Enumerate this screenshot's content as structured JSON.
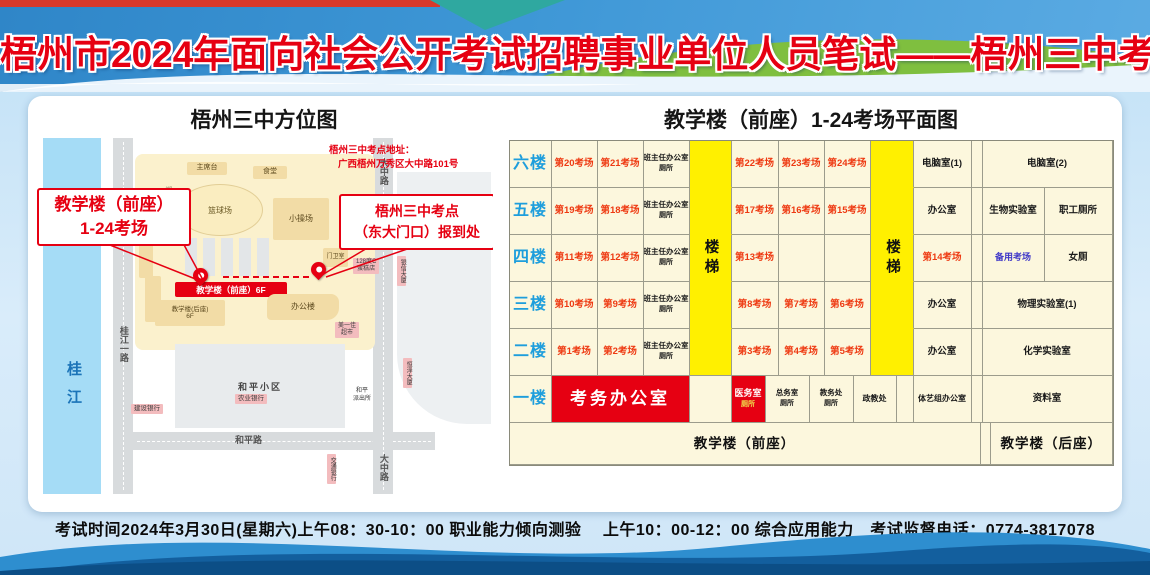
{
  "header": {
    "title": "梧州市2024年面向社会公开考试招聘事业单位人员笔试——梧州三中考点"
  },
  "map": {
    "title": "梧州三中方位图",
    "river": "桂江",
    "road_guijiang": "桂江一路",
    "road_heping": "和平路",
    "road_dazhong_top": "大中路",
    "road_dazhong_bottom": "大中路",
    "track": "塑胶跑道",
    "library": "图书综合楼",
    "stage": "主席台",
    "canteen": "食堂",
    "basketball": "篮球场",
    "playground": "小操场",
    "gatehouse": "门卫室",
    "office_building": "办公楼",
    "teaching_front_banner": "教学楼（前座）6F",
    "teaching_rear": "教学楼(后座)",
    "teaching_rear_floors": "6F",
    "community": "和平小区",
    "poi_ccb": "建设银行",
    "poi_abc": "农业银行",
    "poi_bocom": "交通银行",
    "poi_police_1": "和平",
    "poi_police_2": "派出所",
    "poi_market_1": "美一佳",
    "poi_market_2": "超市",
    "poi_cake_1": "128度C",
    "poi_cake_2": "蛋糕店",
    "poi_tower1": "银信大厦",
    "poi_tower2": "恒泽大厦",
    "callout1_line1": "教学楼（前座）",
    "callout1_line2": "1-24考场",
    "callout2_line1": "梧州三中考点",
    "callout2_line2": "（东大门口）报到处",
    "address_line1": "梧州三中考点地址：",
    "address_line2": "广西梧州万秀区大中路101号"
  },
  "plan": {
    "title": "教学楼（前座）1-24考场平面图",
    "floor_col_w": 42,
    "floors": [
      {
        "floor": "六楼",
        "cells": [
          {
            "t": "第20考场",
            "w": 46,
            "c": "c-exam"
          },
          {
            "t": "第21考场",
            "w": 46,
            "c": "c-exam"
          },
          {
            "t": "班主任办公室",
            "s": "厕所",
            "w": 46,
            "c": "c-small"
          },
          {
            "t": "",
            "w": 42,
            "c": "c-stair"
          },
          {
            "t": "第22考场",
            "w": 47,
            "c": "c-exam"
          },
          {
            "t": "第23考场",
            "w": 46,
            "c": "c-exam"
          },
          {
            "t": "第24考场",
            "w": 46,
            "c": "c-exam"
          },
          {
            "t": "",
            "w": 43,
            "c": "c-stair"
          },
          {
            "t": "电脑室(1)",
            "w": 58,
            "c": "c-room"
          },
          {
            "t": "",
            "w": 11,
            "c": "c-room"
          },
          {
            "t": "电脑室(2)",
            "w": 130,
            "c": "c-room"
          }
        ]
      },
      {
        "floor": "五楼",
        "cells": [
          {
            "t": "第19考场",
            "w": 46,
            "c": "c-exam"
          },
          {
            "t": "第18考场",
            "w": 46,
            "c": "c-exam"
          },
          {
            "t": "班主任办公室",
            "s": "厕所",
            "w": 46,
            "c": "c-small"
          },
          {
            "t": "",
            "w": 42,
            "c": "c-stair"
          },
          {
            "t": "第17考场",
            "w": 47,
            "c": "c-exam"
          },
          {
            "t": "第16考场",
            "w": 46,
            "c": "c-exam"
          },
          {
            "t": "第15考场",
            "w": 46,
            "c": "c-exam"
          },
          {
            "t": "",
            "w": 43,
            "c": "c-stair"
          },
          {
            "t": "办公室",
            "w": 58,
            "c": "c-room"
          },
          {
            "t": "",
            "w": 11,
            "c": "c-room"
          },
          {
            "t": "生物实验室",
            "w": 62,
            "c": "c-room"
          },
          {
            "t": "职工厕所",
            "w": 68,
            "c": "c-room"
          }
        ]
      },
      {
        "floor": "四楼",
        "cells": [
          {
            "t": "第11考场",
            "w": 46,
            "c": "c-exam"
          },
          {
            "t": "第12考场",
            "w": 46,
            "c": "c-exam"
          },
          {
            "t": "班主任办公室",
            "s": "厕所",
            "w": 46,
            "c": "c-small"
          },
          {
            "t": "楼梯",
            "w": 42,
            "c": "c-stair",
            "v": true
          },
          {
            "t": "第13考场",
            "w": 47,
            "c": "c-exam"
          },
          {
            "t": "",
            "w": 46,
            "c": "c-room"
          },
          {
            "t": "",
            "w": 46,
            "c": "c-room"
          },
          {
            "t": "楼梯",
            "w": 43,
            "c": "c-stair",
            "v": true
          },
          {
            "t": "第14考场",
            "w": 58,
            "c": "c-exam"
          },
          {
            "t": "",
            "w": 11,
            "c": "c-room"
          },
          {
            "t": "备用考场",
            "w": 62,
            "c": "c-backup"
          },
          {
            "t": "女厕",
            "w": 68,
            "c": "c-room"
          }
        ]
      },
      {
        "floor": "三楼",
        "cells": [
          {
            "t": "第10考场",
            "w": 46,
            "c": "c-exam"
          },
          {
            "t": "第9考场",
            "w": 46,
            "c": "c-exam"
          },
          {
            "t": "班主任办公室",
            "s": "厕所",
            "w": 46,
            "c": "c-small"
          },
          {
            "t": "",
            "w": 42,
            "c": "c-stair"
          },
          {
            "t": "第8考场",
            "w": 47,
            "c": "c-exam"
          },
          {
            "t": "第7考场",
            "w": 46,
            "c": "c-exam"
          },
          {
            "t": "第6考场",
            "w": 46,
            "c": "c-exam"
          },
          {
            "t": "",
            "w": 43,
            "c": "c-stair"
          },
          {
            "t": "办公室",
            "w": 58,
            "c": "c-room"
          },
          {
            "t": "",
            "w": 11,
            "c": "c-room"
          },
          {
            "t": "物理实验室(1)",
            "w": 130,
            "c": "c-room"
          }
        ]
      },
      {
        "floor": "二楼",
        "cells": [
          {
            "t": "第1考场",
            "w": 46,
            "c": "c-exam"
          },
          {
            "t": "第2考场",
            "w": 46,
            "c": "c-exam"
          },
          {
            "t": "班主任办公室",
            "s": "厕所",
            "w": 46,
            "c": "c-small"
          },
          {
            "t": "",
            "w": 42,
            "c": "c-stair end"
          },
          {
            "t": "第3考场",
            "w": 47,
            "c": "c-exam"
          },
          {
            "t": "第4考场",
            "w": 46,
            "c": "c-exam"
          },
          {
            "t": "第5考场",
            "w": 46,
            "c": "c-exam"
          },
          {
            "t": "",
            "w": 43,
            "c": "c-stair end"
          },
          {
            "t": "办公室",
            "w": 58,
            "c": "c-room"
          },
          {
            "t": "",
            "w": 11,
            "c": "c-room"
          },
          {
            "t": "化学实验室",
            "w": 130,
            "c": "c-room"
          }
        ]
      },
      {
        "floor": "一楼",
        "cells": [
          {
            "t": "考务办公室",
            "w": 138,
            "c": "c-redbig"
          },
          {
            "t": "",
            "w": 42,
            "c": "c-room"
          },
          {
            "t": "医务室",
            "s": "厕所",
            "w": 34,
            "c": "c-redsm"
          },
          {
            "t": "总务室",
            "s": "厕所",
            "w": 44,
            "c": "c-small"
          },
          {
            "t": "教务处",
            "s": "厕所",
            "w": 44,
            "c": "c-small"
          },
          {
            "t": "政教处",
            "w": 43,
            "c": "c-room-xs"
          },
          {
            "t": "",
            "w": 17,
            "c": "c-room"
          },
          {
            "t": "体艺组办公室",
            "w": 58,
            "c": "c-room-xs"
          },
          {
            "t": "",
            "w": 11,
            "c": "c-room"
          },
          {
            "t": "资料室",
            "w": 130,
            "c": "c-room"
          }
        ]
      }
    ],
    "footer": {
      "front": "教学楼（前座）",
      "front_w": 462,
      "spacer_w": 11,
      "rear": "教学楼（后座）",
      "rear_w": 130
    }
  },
  "bottom_bar": {
    "text": "考试时间2024年3月30日(星期六)上午08：30-10：00 职业能力倾向测验　 上午10：00-12：00 综合应用能力　考试监督电话：0774-3817078"
  },
  "colors": {
    "accent_red": "#E60012",
    "stair_yellow": "#FFF000",
    "floor_blue": "#1E9EDC",
    "exam_red": "#EE3A12",
    "backup_blue": "#4038C8"
  }
}
